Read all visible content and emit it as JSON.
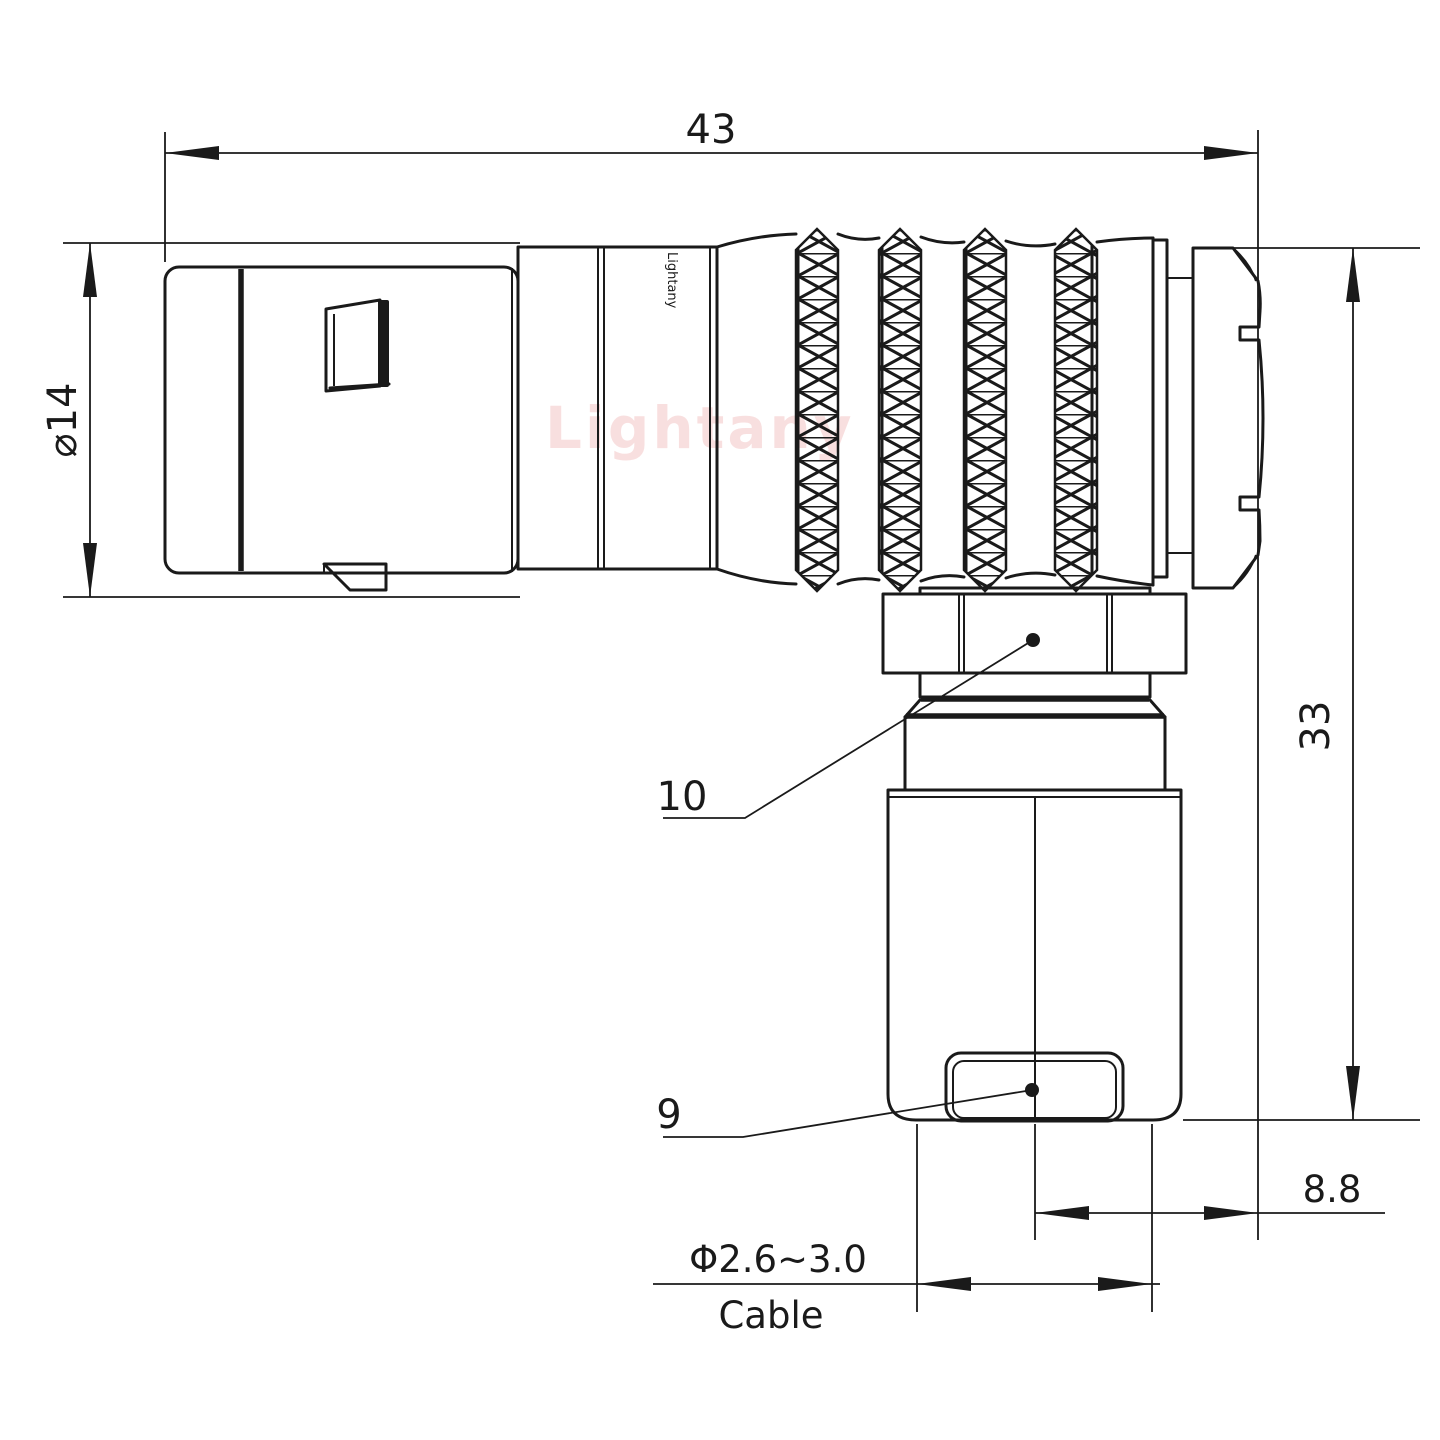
{
  "drawing": {
    "type": "engineering-dimension-drawing",
    "subject": "right-angle push-pull circular connector, side view",
    "watermark": {
      "text": "Lightany",
      "color": "#ec9f9f"
    },
    "body_brand_label": "Lightany",
    "dimensions": {
      "overall_length": "43",
      "front_diameter": "⌀14",
      "overall_height": "33",
      "back_offset": "8.8",
      "cable_diameter_range": "Φ2.6~3.0",
      "cable_word": "Cable",
      "part_ref_nut": "10",
      "part_ref_clamp": "9"
    },
    "colors": {
      "line": "#1a1a1a",
      "background": "#ffffff",
      "watermark": "#ec9f9f"
    }
  }
}
